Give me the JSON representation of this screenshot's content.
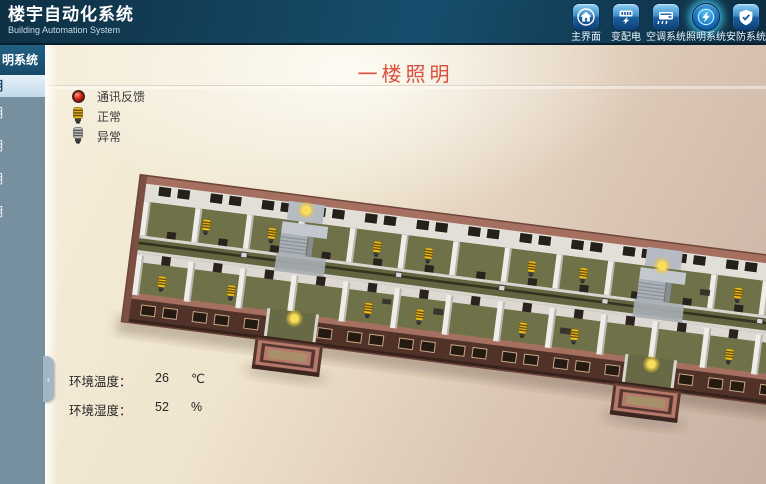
{
  "app": {
    "title": "楼宇自动化系统",
    "subtitle": "Building Automation System"
  },
  "nav": {
    "items": [
      {
        "label": "主界面",
        "icon": "home-icon",
        "active": false
      },
      {
        "label": "变配电",
        "icon": "power-distribution-icon",
        "active": false
      },
      {
        "label": "空调系统",
        "icon": "hvac-icon",
        "active": false
      },
      {
        "label": "照明系统",
        "icon": "lighting-icon",
        "active": true
      },
      {
        "label": "安防系统",
        "icon": "security-icon",
        "active": false
      }
    ]
  },
  "sidebar": {
    "header": "明系统",
    "items": [
      {
        "label": "明",
        "selected": true
      },
      {
        "label": "明",
        "selected": false
      },
      {
        "label": "明",
        "selected": false
      },
      {
        "label": "明",
        "selected": false
      },
      {
        "label": "明",
        "selected": false
      }
    ],
    "collapse_glyph": "‹"
  },
  "page": {
    "title": "一楼照明"
  },
  "legend": {
    "items": [
      {
        "icon": "comm-indicator",
        "label": "通讯反馈",
        "color": "#e0261a"
      },
      {
        "icon": "bulb-on-icon",
        "label": "正常",
        "color": "#e8bd1c"
      },
      {
        "icon": "bulb-off-icon",
        "label": "异常",
        "color": "#c6c6c6"
      }
    ]
  },
  "environment": {
    "temperature": {
      "label": "环境温度：",
      "value": "26",
      "unit": "℃"
    },
    "humidity": {
      "label": "环境湿度：",
      "value": "52",
      "unit": "%"
    }
  },
  "colors": {
    "header_bg": "#12425e",
    "sidebar_bg": "#76909f",
    "accent_red": "#db4f3c",
    "content_bg": "#e9dcc6"
  }
}
